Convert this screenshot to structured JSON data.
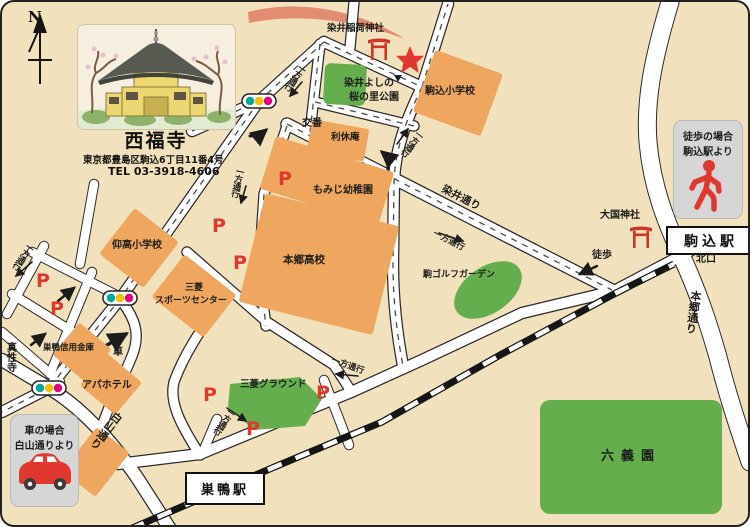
{
  "temple": {
    "name": "西福寺",
    "address": "東京都豊島区駒込6丁目11番4号",
    "tel": "TEL 03-3918-4606"
  },
  "compass": {
    "north": "N"
  },
  "guide": {
    "walk": {
      "line1": "徒歩の場合",
      "line2": "駒込駅より"
    },
    "car": {
      "line1": "車の場合",
      "line2": "白山通りより"
    }
  },
  "stations": {
    "komagome": "駒込駅",
    "komagome_north_exit": "北口",
    "sugamo": "巣鴨駅"
  },
  "roads": {
    "somei": "染井通り",
    "hongo": "本郷通り",
    "hakusan": "白山通り"
  },
  "places": {
    "somei_inari_shrine": "染井稲荷神社",
    "park_line1": "染井よしの",
    "park_line2": "桜の里公園",
    "komagome_elementary": "駒込小学校",
    "police_box": "交番",
    "rikyu_an": "利休庵",
    "momiji_kindergarten": "もみじ幼稚園",
    "hongo_highschool": "本郷高校",
    "gyoko_elementary": "仰高小学校",
    "mitsubishi_sports_line1": "三菱",
    "mitsubishi_sports_line2": "スポーツセンター",
    "koma_golf_garden": "駒ゴルフガーデン",
    "sugamo_shinkin_bank": "巣鴨信用金庫",
    "apa_hotel": "アパホテル",
    "shinsho_ji": "真性寺",
    "mitsubishi_ground": "三菱グラウンド",
    "rikugien": "六義園",
    "daikoku_shrine": "大国神社"
  },
  "annotations": {
    "one_way": "一方通行",
    "walk": "徒歩",
    "car": "車",
    "parking": "P"
  },
  "colors": {
    "accent_red": "#e0382e",
    "building_orange": "#efa75f",
    "park_green": "#64ae4d",
    "background_tan": "#f2e1bd",
    "info_box_gray": "#d6d6d6",
    "signal_teal": "#00a79b",
    "signal_yellow": "#f3c000",
    "signal_magenta": "#e3007f",
    "route_swoosh_salmon": "#e28c72"
  }
}
